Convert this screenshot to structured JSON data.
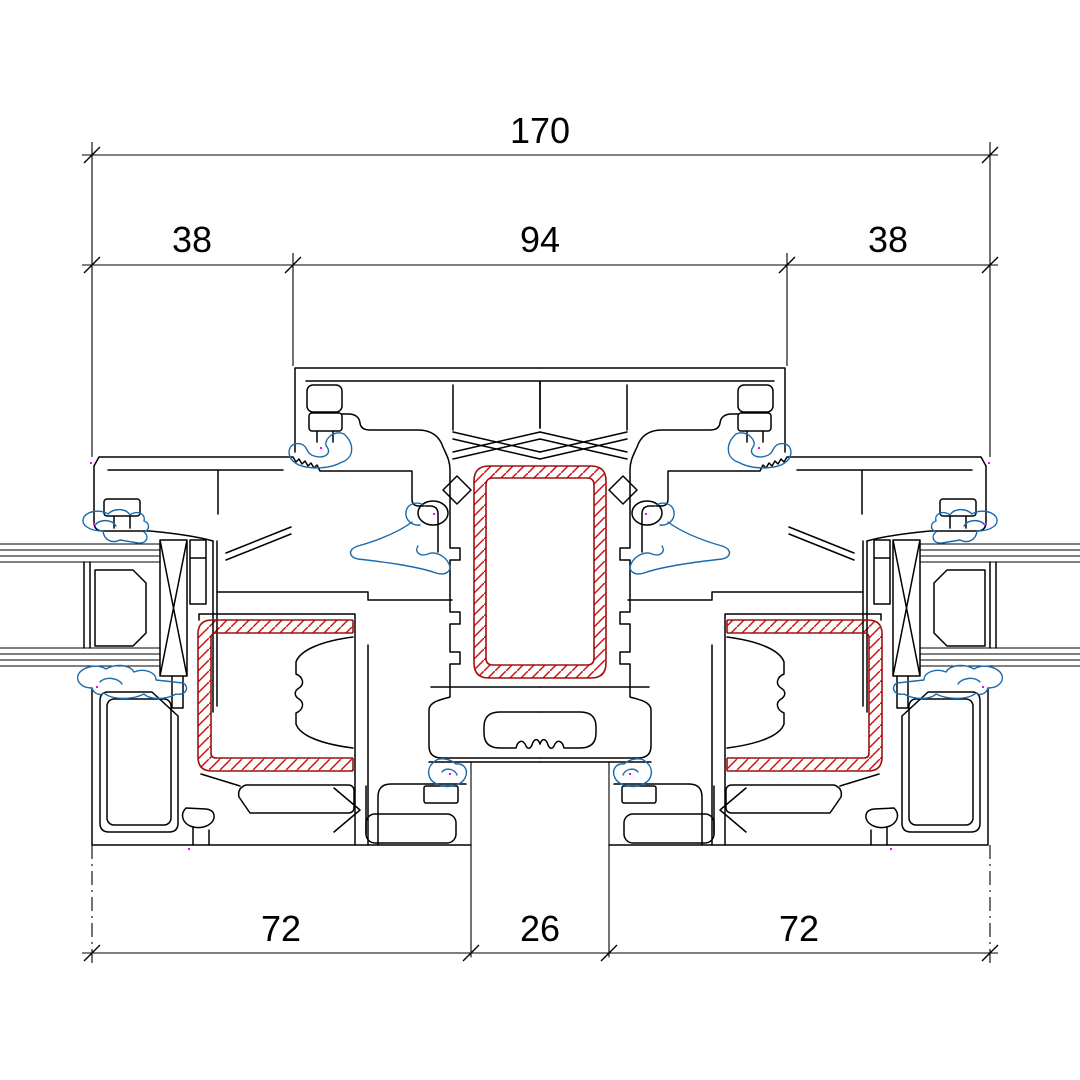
{
  "drawing": {
    "kind": "window-profile-cross-section"
  },
  "dimensions": {
    "overall_width": "170",
    "top_row": [
      "38",
      "94",
      "38"
    ],
    "bottom_row": [
      "72",
      "26",
      "72"
    ]
  },
  "colors": {
    "line": "#000000",
    "steel_outline": "#9e1111",
    "steel_hatch": "#cc1111",
    "gasket": "#1a6aad",
    "marker": "#ff00ff"
  }
}
